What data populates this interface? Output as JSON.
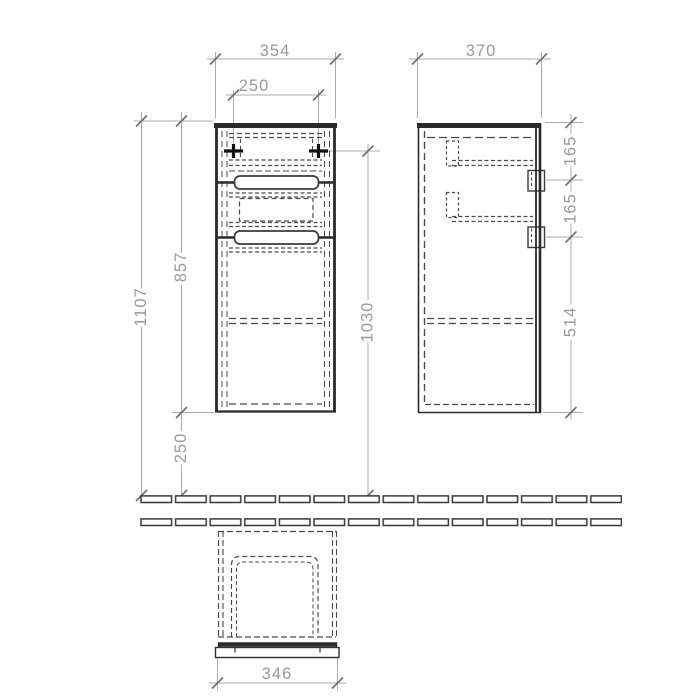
{
  "drawing_type": "furniture-cabinet-technical-drawing",
  "colors": {
    "outline": "#2a2a2a",
    "dim_line": "#ababab",
    "dim_text": "#9a9a9a",
    "hidden_line": "#4a4a4a"
  },
  "dimensions": {
    "front_view": {
      "width_mm": "354",
      "mount_hole_spacing_mm": "250",
      "total_height_mm": "1107",
      "cabinet_height_mm": "857",
      "floor_clearance_mm": "250",
      "mount_height_mm": "1030"
    },
    "side_view": {
      "depth_mm": "370",
      "top_to_handle_mm": "165",
      "handle_spacing_mm": "165",
      "handle_to_bottom_mm": "514"
    },
    "top_view": {
      "width_mm": "346"
    }
  }
}
